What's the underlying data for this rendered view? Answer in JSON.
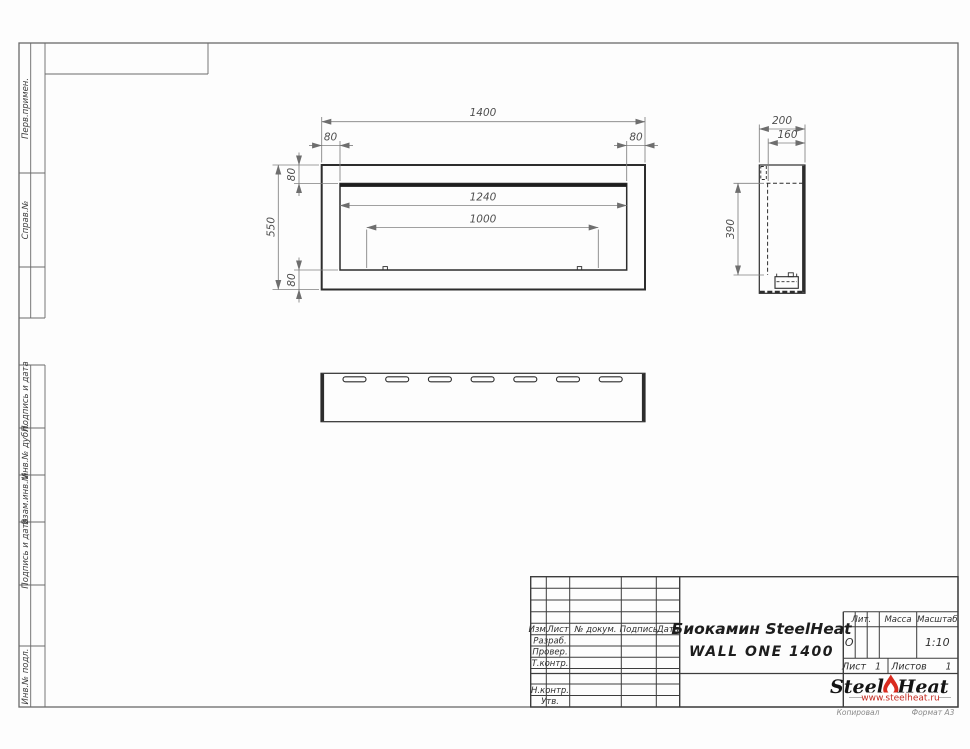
{
  "drawing": {
    "front_view": {
      "overall_width": "1400",
      "left_margin": "80",
      "right_margin": "80",
      "top_margin": "80",
      "bottom_margin": "80",
      "overall_height": "550",
      "opening_width": "1240",
      "burner_length": "1000"
    },
    "side_view": {
      "depth": "200",
      "inner_depth": "160",
      "opening_height": "390"
    }
  },
  "sidebar": {
    "labels": [
      "Перв.примен.",
      "Справ.№",
      "Подпись и дата",
      "Инв.№ дубл.",
      "Взам.инв.№",
      "Подпись и дата",
      "Инв.№ подл."
    ]
  },
  "title_block": {
    "header_cols": {
      "izm": "Изм.",
      "sheet": "Лист",
      "doc_no": "№ докум.",
      "sign": "Подпись",
      "date": "Дата"
    },
    "signature_rows": {
      "developed": "Разраб.",
      "checked": "Провер.",
      "tcontrol": "Т.контр.",
      "ncontrol": "Н.контр.",
      "approved": "Утв."
    },
    "doc_title_line1": "Биокамин SteelHeat",
    "doc_title_line2": "WALL ONE 1400",
    "lit": {
      "label": "Лит.",
      "value": "О"
    },
    "mass": {
      "label": "Масса"
    },
    "scale": {
      "label": "Масштаб",
      "value": "1:10"
    },
    "sheet_no": {
      "label": "Лист",
      "value": "1"
    },
    "sheets_total": {
      "label": "Листов",
      "value": "1"
    },
    "logo": {
      "part1": "Steel",
      "part2": "Heat",
      "website": "www.steelheat.ru",
      "flame_color": "#d92b1f"
    },
    "footer": {
      "copied": "Копировал",
      "format": "Формат А3"
    }
  }
}
